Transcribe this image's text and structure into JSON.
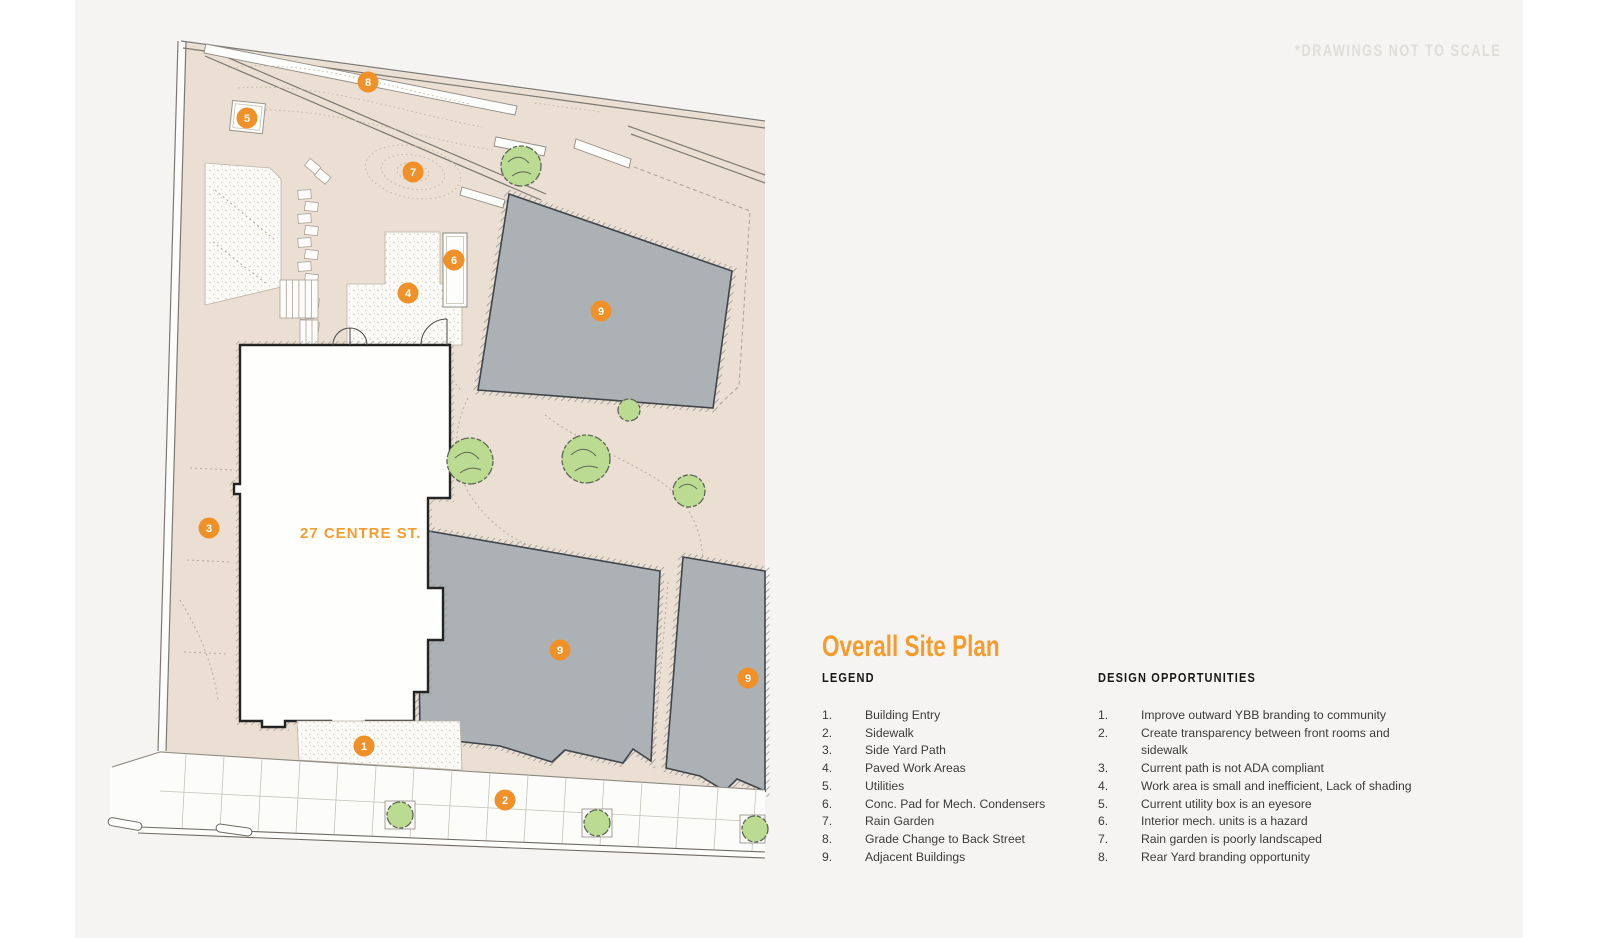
{
  "note": "*DRAWINGS NOT TO SCALE",
  "title": "Overall Site Plan",
  "plan": {
    "building_label": "27 CENTRE ST.",
    "markers": [
      {
        "label": "1",
        "x": 364,
        "y": 746
      },
      {
        "label": "2",
        "x": 505,
        "y": 800
      },
      {
        "label": "3",
        "x": 209,
        "y": 528
      },
      {
        "label": "4",
        "x": 408,
        "y": 293
      },
      {
        "label": "5",
        "x": 247,
        "y": 118
      },
      {
        "label": "6",
        "x": 454,
        "y": 260
      },
      {
        "label": "7",
        "x": 413,
        "y": 172
      },
      {
        "label": "8",
        "x": 368,
        "y": 82
      },
      {
        "label": "9",
        "x": 601,
        "y": 311
      },
      {
        "label": "9",
        "x": 560,
        "y": 650
      },
      {
        "label": "9",
        "x": 748,
        "y": 678
      }
    ]
  },
  "legend": {
    "heading": "LEGEND",
    "items": [
      {
        "n": "1.",
        "t": "Building Entry"
      },
      {
        "n": "2.",
        "t": "Sidewalk"
      },
      {
        "n": "3.",
        "t": "Side Yard Path"
      },
      {
        "n": "4.",
        "t": "Paved Work Areas"
      },
      {
        "n": "5.",
        "t": "Utilities"
      },
      {
        "n": "6.",
        "t": "Conc. Pad for Mech. Condensers"
      },
      {
        "n": "7.",
        "t": "Rain Garden"
      },
      {
        "n": "8.",
        "t": "Grade Change to Back Street"
      },
      {
        "n": "9.",
        "t": "Adjacent Buildings"
      }
    ]
  },
  "opportunities": {
    "heading": "DESIGN OPPORTUNITIES",
    "items": [
      {
        "n": "1.",
        "t": "Improve outward YBB branding to community"
      },
      {
        "n": "2.",
        "t": "Create transparency between front rooms and\nsidewalk"
      },
      {
        "n": "3.",
        "t": "Current path is not ADA compliant"
      },
      {
        "n": "4.",
        "t": "Work area is small and inefficient, Lack of shading"
      },
      {
        "n": "5.",
        "t": "Current utility box is an eyesore"
      },
      {
        "n": "6.",
        "t": "Interior mech. units is a hazard"
      },
      {
        "n": "7.",
        "t": "Rain garden is poorly landscaped"
      },
      {
        "n": "8.",
        "t": "Rear Yard branding opportunity"
      }
    ]
  },
  "colors": {
    "accent_orange": "#EF9128",
    "title_orange": "#F59C2F",
    "site_beige": "#EADFD2",
    "building_gray": "#ACB1B6",
    "tree_green": "#BCDB92",
    "note_gray": "#DEDDDA"
  }
}
